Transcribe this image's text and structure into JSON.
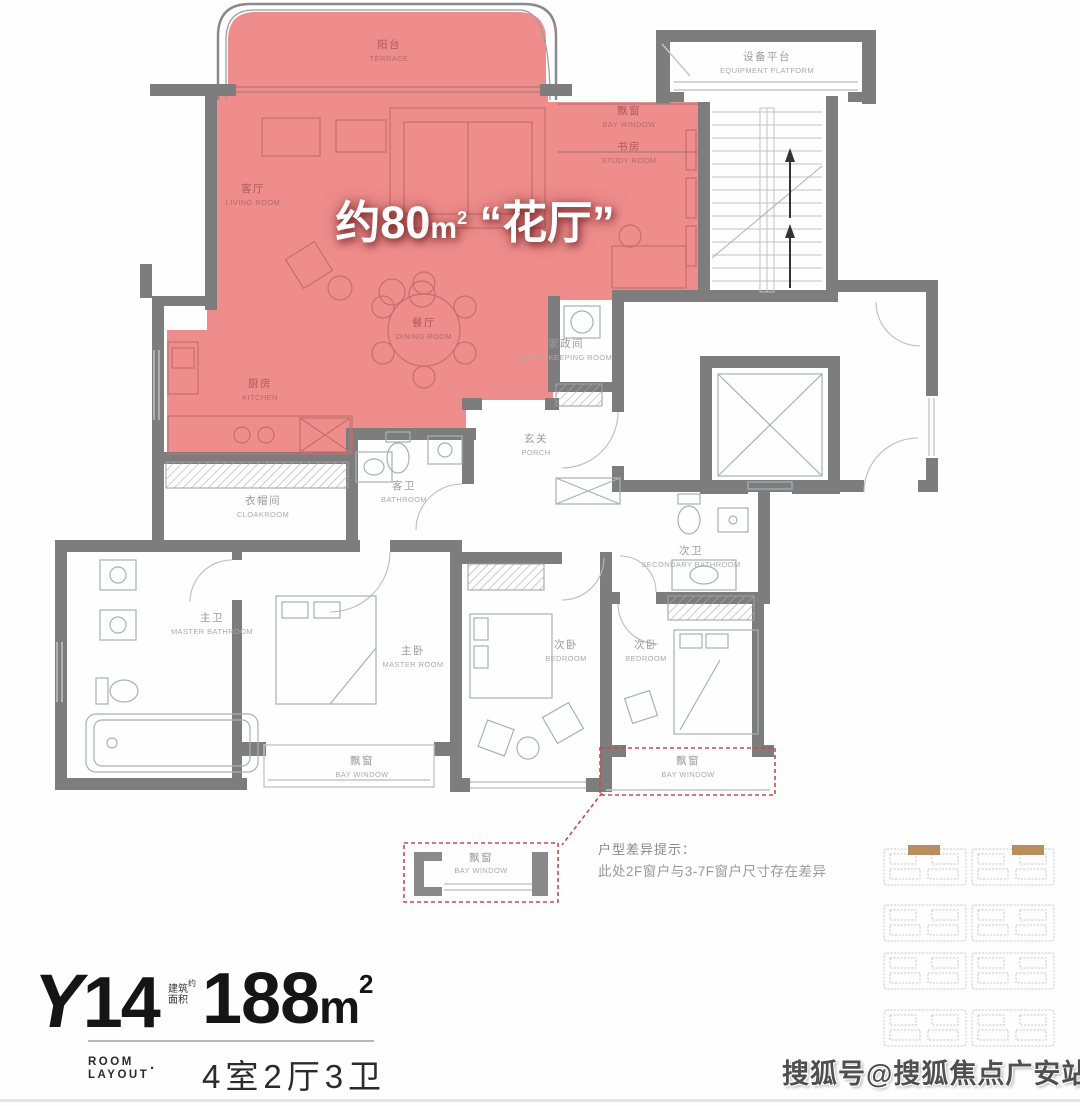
{
  "highlight": {
    "prefix": "约80",
    "unit": "m",
    "sup": "2",
    "name": "“花厅”"
  },
  "rooms": [
    {
      "id": "terrace",
      "zh": "阳台",
      "en": "TERRACE"
    },
    {
      "id": "bay-window-top",
      "zh": "飘窗",
      "en": "BAY WINDOW"
    },
    {
      "id": "study",
      "zh": "书房",
      "en": "STUDY ROOM"
    },
    {
      "id": "living-room",
      "zh": "客厅",
      "en": "LIVING ROOM"
    },
    {
      "id": "dining-room",
      "zh": "餐厅",
      "en": "DINING ROOM"
    },
    {
      "id": "kitchen",
      "zh": "厨房",
      "en": "KITCHEN"
    },
    {
      "id": "housekeeping-room",
      "zh": "家政间",
      "en": "HOUSEKEEPING ROOM"
    },
    {
      "id": "equipment-platform",
      "zh": "设备平台",
      "en": "EQUIPMENT PLATFORM"
    },
    {
      "id": "porch",
      "zh": "玄关",
      "en": "PORCH"
    },
    {
      "id": "guest-bathroom",
      "zh": "客卫",
      "en": "BATHROOM"
    },
    {
      "id": "cloakroom",
      "zh": "衣帽间",
      "en": "CLOAKROOM"
    },
    {
      "id": "master-bathroom",
      "zh": "主卫",
      "en": "MASTER BATHROOM"
    },
    {
      "id": "master-bedroom",
      "zh": "主卧",
      "en": "MASTER ROOM"
    },
    {
      "id": "bay-window-master",
      "zh": "飘窗",
      "en": "BAY WINDOW"
    },
    {
      "id": "bedroom-center",
      "zh": "次卧",
      "en": "BEDROOM"
    },
    {
      "id": "secondary-bathroom",
      "zh": "次卫",
      "en": "SECONDARY BATHROOM"
    },
    {
      "id": "bedroom-right",
      "zh": "次卧",
      "en": "BEDROOM"
    },
    {
      "id": "bay-window-right",
      "zh": "飘窗",
      "en": "BAY WINDOW"
    },
    {
      "id": "bay-window-detail",
      "zh": "飘窗",
      "en": "BAY WINDOW"
    }
  ],
  "note": {
    "title": "户型差异提示：",
    "body": "此处2F窗户与3-7F窗户尺寸存在差异"
  },
  "title_block": {
    "model_letter": "Y",
    "model_number": "14",
    "area_small_1": "建筑",
    "area_small_2": "面积",
    "area_small_3": "约",
    "area_value": "188",
    "area_unit": "m",
    "area_unit_sup": "2",
    "category_line1": "ROOM",
    "category_line2": "LAYOUT",
    "dot": "·",
    "config": "4室2厅3卫"
  },
  "watermark": {
    "text": "搜狐号@搜狐焦点广安站"
  },
  "colors": {
    "highlight_fill": "#ef8d8d",
    "wall": "#7d7d7d",
    "dashed_accent": "#c64a4a",
    "keyplan_highlight": "#b98e5f"
  }
}
